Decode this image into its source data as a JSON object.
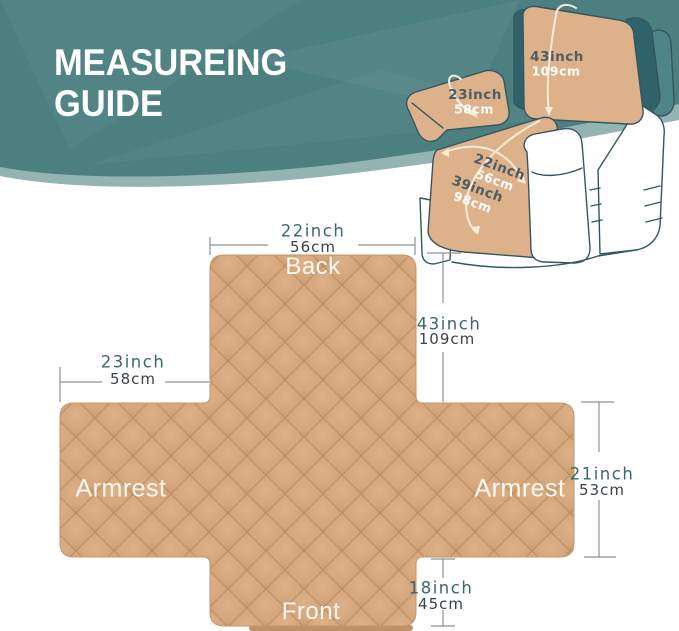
{
  "header": {
    "title_line1": "MEASUREING",
    "title_line2": "GUIDE"
  },
  "chair": {
    "back_height": {
      "inch": "43inch",
      "cm": "109cm"
    },
    "armrest_length": {
      "inch": "23inch",
      "cm": "58cm"
    },
    "seat_width": {
      "inch": "22inch",
      "cm": "56cm"
    },
    "seat_length": {
      "inch": "39inch",
      "cm": "98cm"
    }
  },
  "cover": {
    "labels": {
      "back": "Back",
      "armrest_left": "Armrest",
      "armrest_right": "Armrest",
      "front": "Front"
    },
    "measure": {
      "top_width": {
        "inch": "22inch",
        "cm": "56cm"
      },
      "back_height": {
        "inch": "43inch",
        "cm": "109cm"
      },
      "armrest_width": {
        "inch": "23inch",
        "cm": "58cm"
      },
      "armrest_height": {
        "inch": "21inch",
        "cm": "53cm"
      },
      "front_height": {
        "inch": "18inch",
        "cm": "45cm"
      }
    }
  },
  "colors": {
    "banner_teal": "#4c7f80",
    "banner_accent": "#93b4b2",
    "cover_tan": "#cfa176",
    "inch_text": "#3d676b",
    "cm_text": "#3b4248",
    "dimension_line": "#8d9296",
    "chair_cover_tan": "#ddb28b",
    "chair_dark_teal": "#30626a"
  }
}
